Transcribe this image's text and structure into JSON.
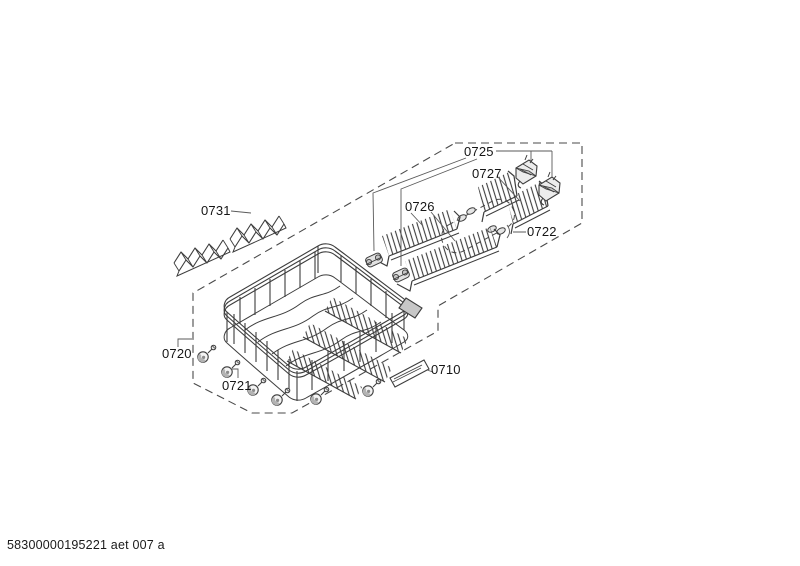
{
  "page": {
    "footer_code": "58300000195221 aet 007 a",
    "background_color": "#ffffff",
    "line_color": "#3d3d3d"
  },
  "diagram": {
    "labels": {
      "p0710": "0710",
      "p0720": "0720",
      "p0721": "0721",
      "p0722": "0722",
      "p0725": "0725",
      "p0726": "0726",
      "p0727": "0727",
      "p0731": "0731"
    }
  }
}
